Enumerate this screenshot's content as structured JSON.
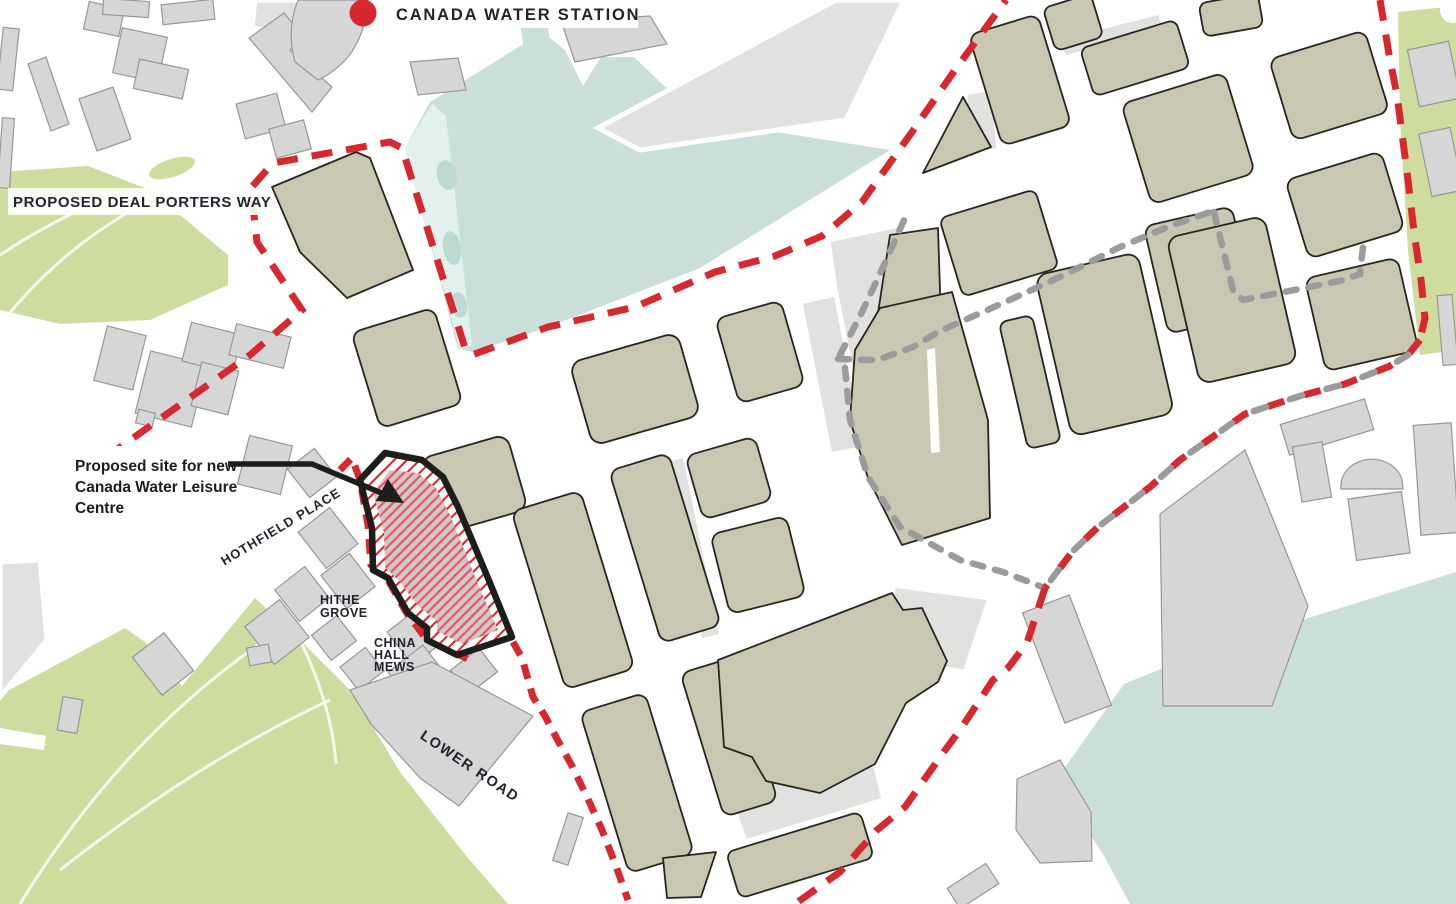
{
  "map": {
    "title": "Canada Water Leisure Centre proposed site masterplan map",
    "labels": {
      "station": "CANADA WATER STATION",
      "deal_porters_way": "PROPOSED DEAL PORTERS WAY",
      "annotation": {
        "line1": "Proposed site for new",
        "line2": "Canada Water Leisure",
        "line3": "Centre"
      },
      "hothfield_place": "HOTHFIELD PLACE",
      "hithe_grove": {
        "line1": "HITHE",
        "line2": "GROVE"
      },
      "china_hall_mews": {
        "line1": "CHINA",
        "line2": "HALL",
        "line3": "MEWS"
      },
      "lower_road": "LOWER ROAD"
    },
    "icons": {
      "station_marker": "red-filled-circle"
    },
    "colors": {
      "boundary_red": "#d7282f",
      "secondary_gray": "#9b9b9b",
      "plot_tan": "#c9c7b2",
      "bldg_gray": "#d6d6d6",
      "park_green": "#cfdca0",
      "water_teal": "#cbdfda",
      "ink": "#1d1d1b",
      "site_hatch_stripe": "#e25673",
      "site_hatch_bg": "#d2c9c2"
    }
  }
}
